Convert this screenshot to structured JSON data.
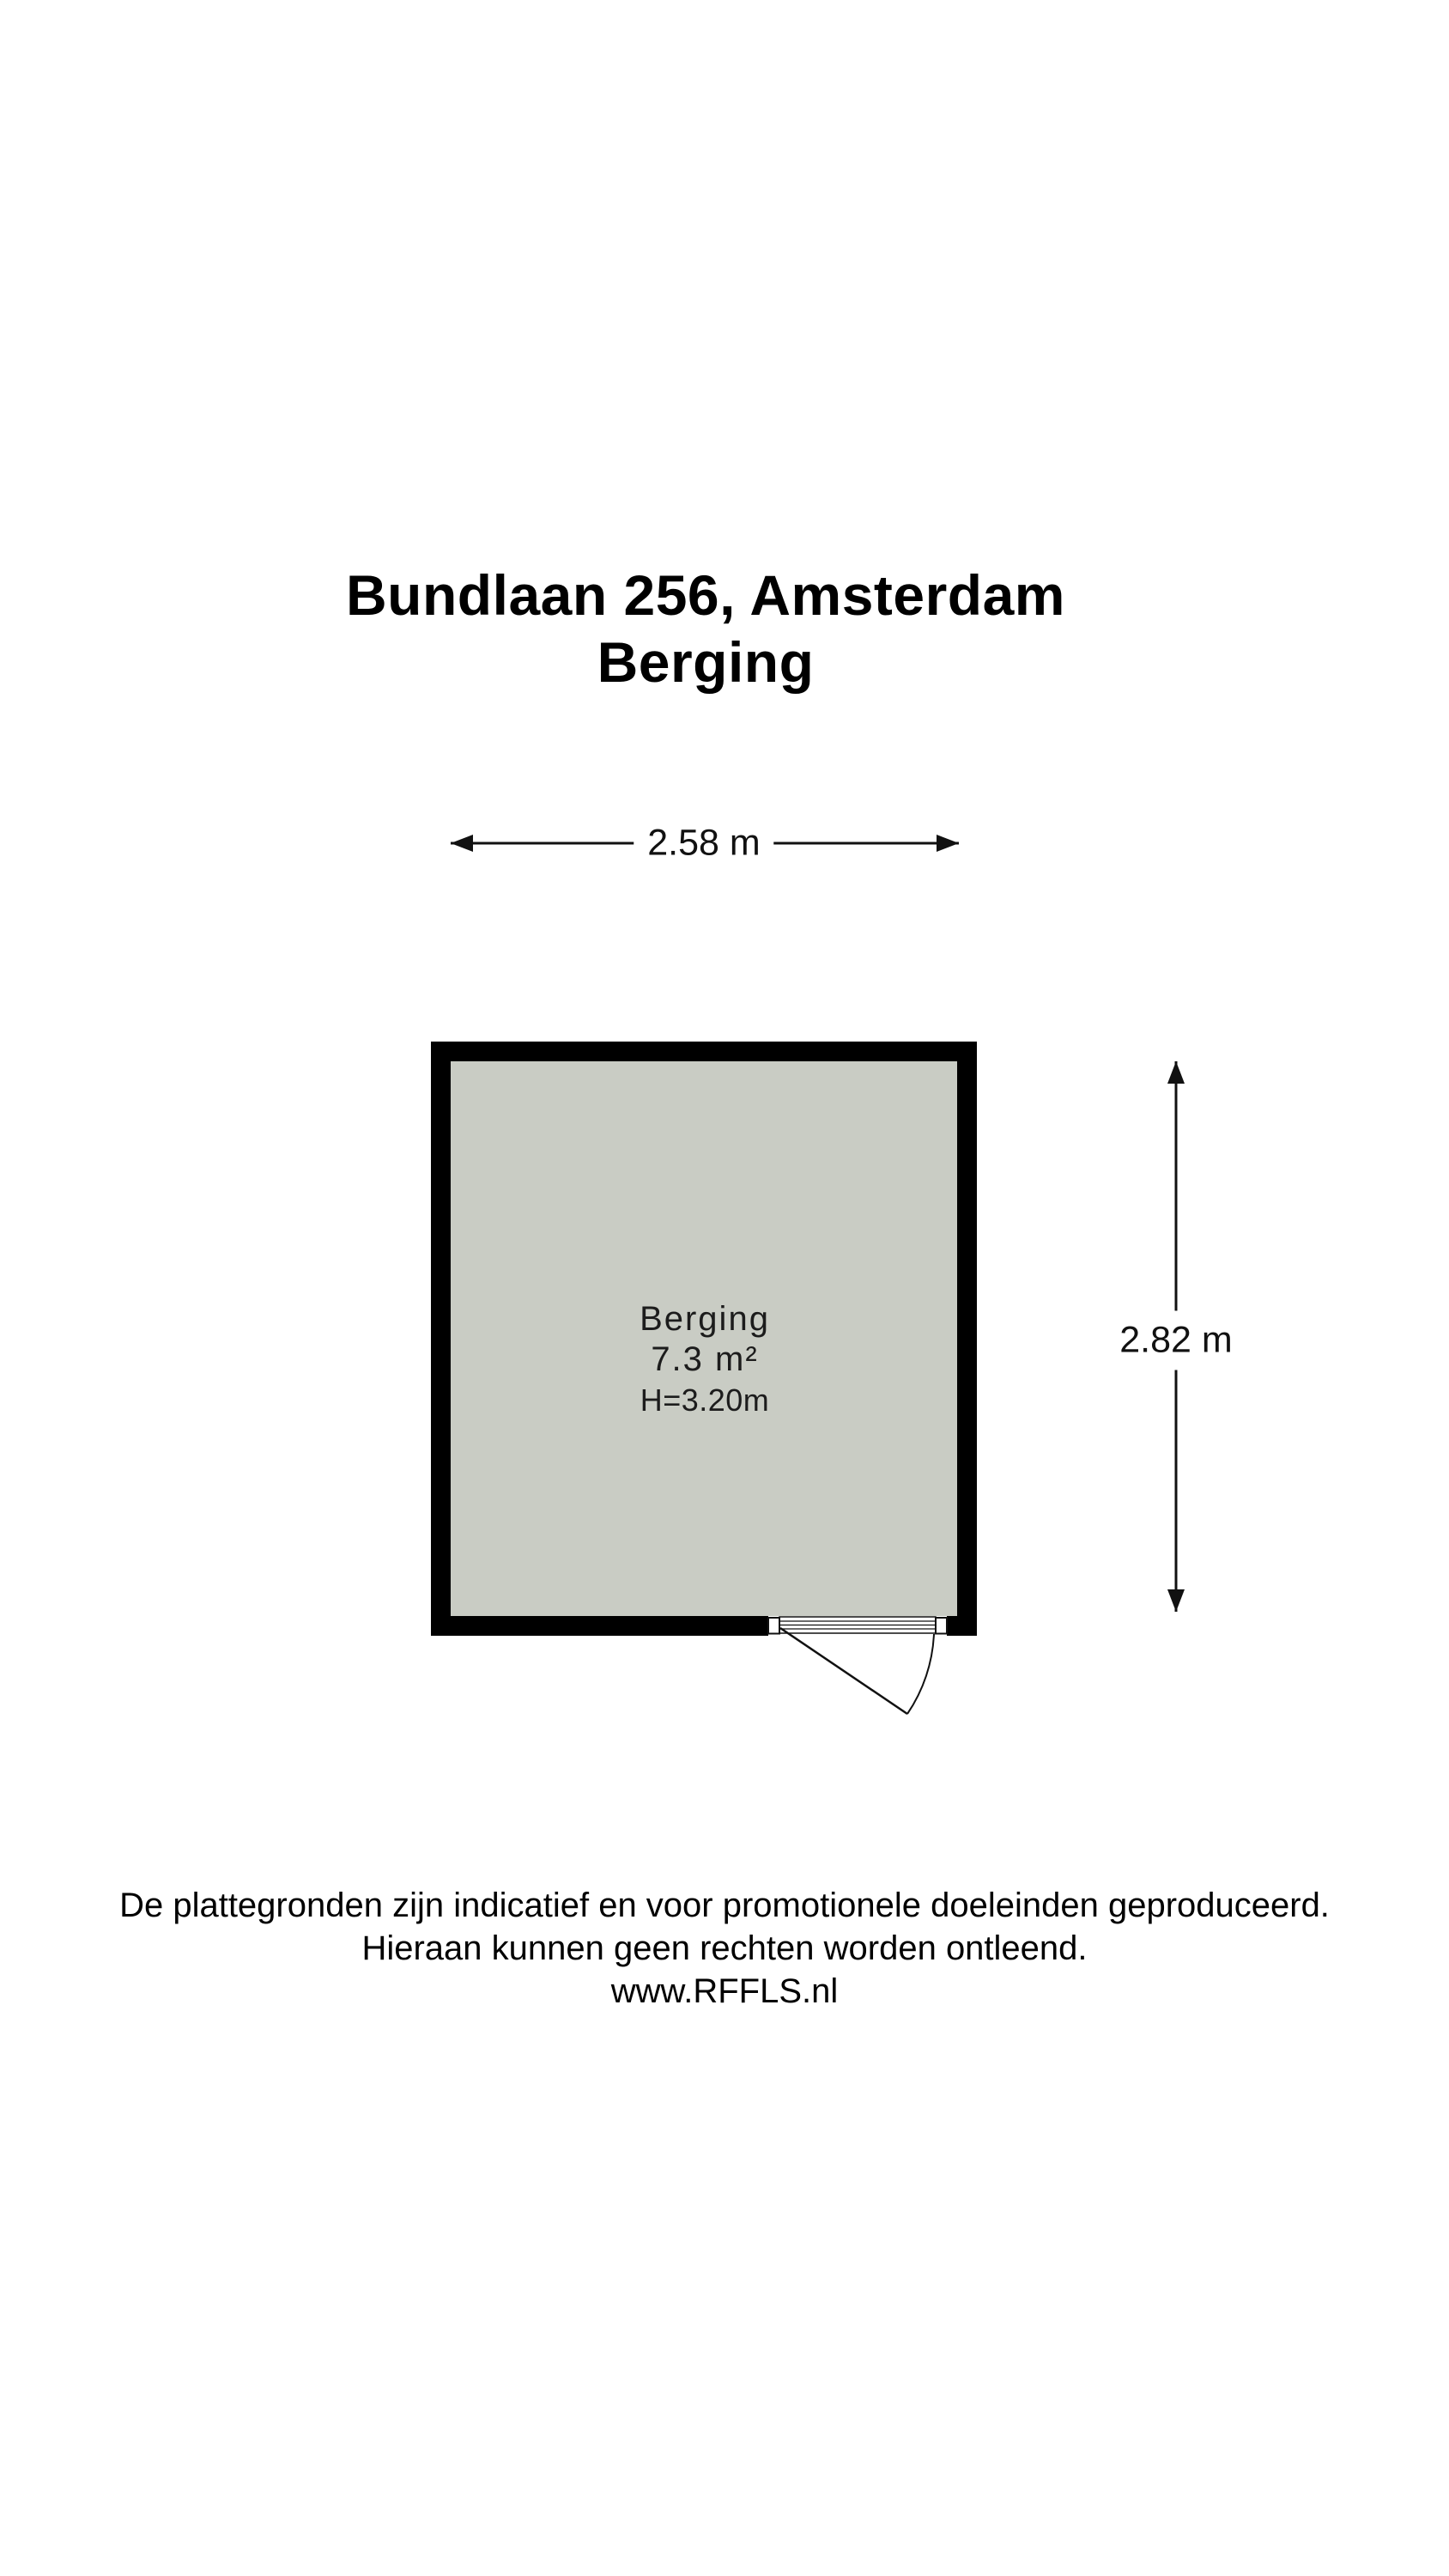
{
  "title": {
    "address": "Bundlaan 256, Amsterdam",
    "room": "Berging"
  },
  "room": {
    "name": "Berging",
    "area": "7.3 m²",
    "ceiling_height": "H=3.20m"
  },
  "dimensions": {
    "width": "2.58 m",
    "height": "2.82 m"
  },
  "footer": {
    "line1": "De plattegronden zijn indicatief en voor promotionele doeleinden geproduceerd.",
    "line2": "Hieraan kunnen geen rechten worden ontleend.",
    "website": "www.RFFLS.nl"
  },
  "colors": {
    "wall": "#000000",
    "floor": "#c9ccc4",
    "line": "#111111",
    "background": "#ffffff"
  }
}
